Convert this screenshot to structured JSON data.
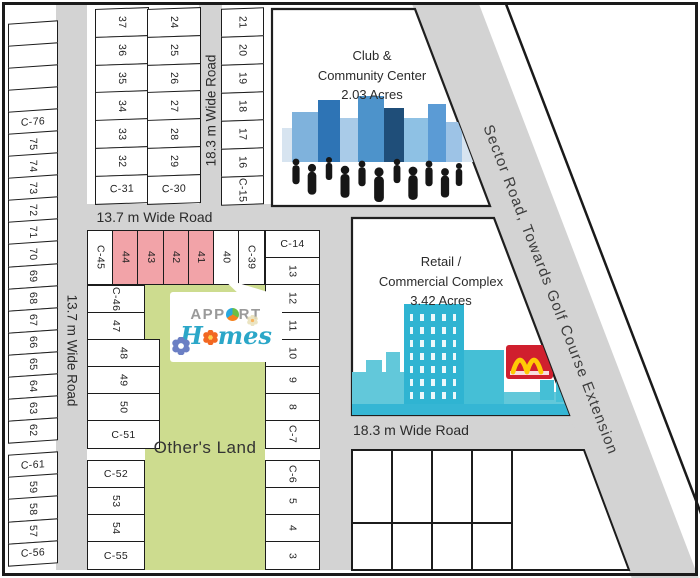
{
  "colors": {
    "border": "#1a1a1a",
    "road": "#d3d3d3",
    "pink": "#f2a3a8",
    "green": "#cddc8f",
    "text": "#2b2b2b",
    "logo_gray": "#9a9a9a",
    "logo_teal": "#2ba7c8",
    "mcd_red": "#d01f2e",
    "mcd_yellow": "#ffca05",
    "sky_cyan": "#2fb4d2",
    "club_blue": "#2e74b5"
  },
  "roads": {
    "left_vertical": "13.7 m Wide Road",
    "top_vertical": "18.3 m Wide Road",
    "mid_horizontal": "13.7 m Wide Road",
    "bottom_horizontal": "18.3 m Wide Road",
    "sector": "Sector Road, Towards Golf Course Extension"
  },
  "blocks": {
    "club": {
      "line1": "Club &",
      "line2": "Community Center",
      "line3": "2.03 Acres"
    },
    "retail": {
      "line1": "Retail /",
      "line2": "Commercial Complex",
      "line3": "3.42 Acres"
    },
    "others_land": "Other's Land"
  },
  "logo": {
    "brand_prefix": "APP",
    "brand_suffix": "RT",
    "homes_first": "H",
    "homes_rest": "mes"
  },
  "plots": {
    "left_column": [
      {
        "t": ""
      },
      {
        "t": ""
      },
      {
        "t": ""
      },
      {
        "t": ""
      },
      {
        "t": "C-76",
        "h": 1
      },
      {
        "t": "75"
      },
      {
        "t": "74"
      },
      {
        "t": "73"
      },
      {
        "t": "72"
      },
      {
        "t": "71"
      },
      {
        "t": "70"
      },
      {
        "t": "69"
      },
      {
        "t": "68"
      },
      {
        "t": "67"
      },
      {
        "t": "66"
      },
      {
        "t": "65"
      },
      {
        "t": "64"
      },
      {
        "t": "63"
      },
      {
        "t": "62"
      },
      {
        "gap": 1
      },
      {
        "t": "C-61",
        "h": 1
      },
      {
        "t": "59"
      },
      {
        "t": "58"
      },
      {
        "t": "57"
      },
      {
        "t": "C-56",
        "h": 1
      }
    ],
    "block_a": [
      {
        "t": "37"
      },
      {
        "t": "36"
      },
      {
        "t": "35"
      },
      {
        "t": "34"
      },
      {
        "t": "33"
      },
      {
        "t": "32"
      },
      {
        "t": "C-31",
        "h": 1
      }
    ],
    "block_b": [
      {
        "t": "24"
      },
      {
        "t": "25"
      },
      {
        "t": "26"
      },
      {
        "t": "27"
      },
      {
        "t": "28"
      },
      {
        "t": "29"
      },
      {
        "t": "C-30",
        "h": 1
      }
    ],
    "block_c": [
      {
        "t": "21"
      },
      {
        "t": "20"
      },
      {
        "t": "19"
      },
      {
        "t": "18"
      },
      {
        "t": "17"
      },
      {
        "t": "16"
      },
      {
        "t": "C-15"
      }
    ],
    "row_mid": [
      {
        "t": "C-45"
      },
      {
        "t": "44",
        "pink": 1
      },
      {
        "t": "43",
        "pink": 1
      },
      {
        "t": "42",
        "pink": 1
      },
      {
        "t": "41",
        "pink": 1
      },
      {
        "t": "40"
      },
      {
        "t": "C-39"
      }
    ],
    "col_mid": [
      {
        "t": "C-46"
      },
      {
        "t": "47"
      },
      {
        "t": "48",
        "wide": 1
      },
      {
        "t": "49",
        "wide": 1
      },
      {
        "t": "50",
        "wide": 1
      },
      {
        "t": "C-51",
        "h": 1,
        "wide": 1
      },
      {
        "gap": 1
      },
      {
        "t": "C-52",
        "h": 1
      },
      {
        "t": "53"
      },
      {
        "t": "54"
      },
      {
        "t": "C-55",
        "h": 1
      }
    ],
    "col_right": [
      {
        "t": "C-14",
        "h": 1
      },
      {
        "t": "13"
      },
      {
        "t": "12"
      },
      {
        "t": "11"
      },
      {
        "t": "10"
      },
      {
        "t": "9"
      },
      {
        "t": "8"
      },
      {
        "t": "C-7"
      },
      {
        "gap": 1
      },
      {
        "t": "C-6"
      },
      {
        "t": "5"
      },
      {
        "t": "4"
      },
      {
        "t": "3"
      }
    ]
  }
}
